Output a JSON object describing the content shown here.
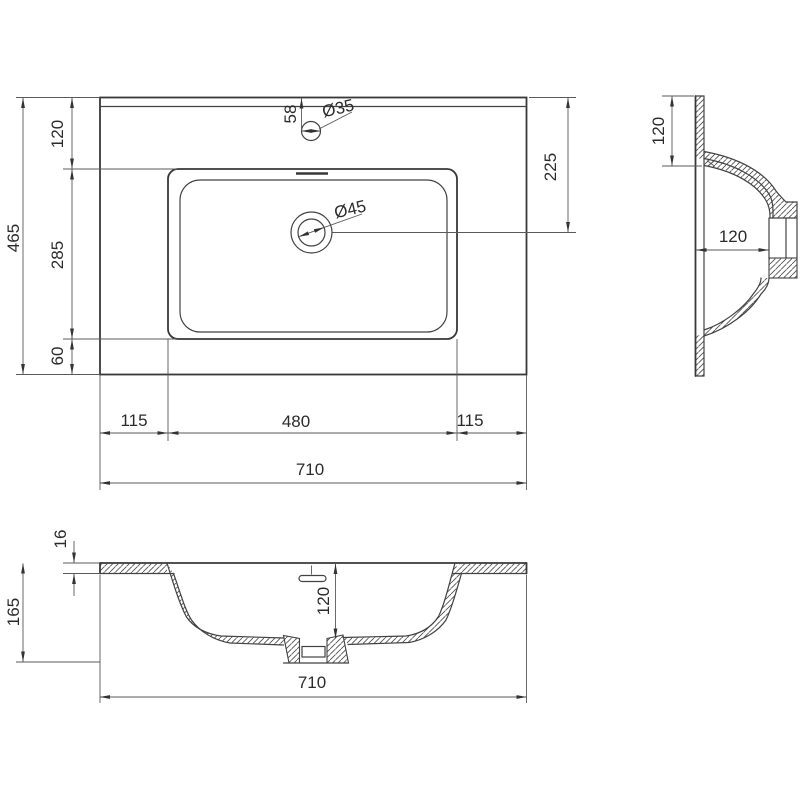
{
  "background": "#ffffff",
  "line_color": "#3a3a3a",
  "drawing": {
    "type": "technical-drawing",
    "subject": "rectangular inset washbasin shown in three orthographic section views with dimensions",
    "views": {
      "plan": {
        "name": "plan view",
        "dims": {
          "depth_total": "465",
          "back_to_bowl": "120",
          "bowl_depth": "285",
          "bowl_to_front": "60",
          "faucet_from_back": "58",
          "faucet_hole_dia": "Ø35",
          "drain_hole_dia": "Ø45",
          "drain_from_back": "225",
          "left_to_bowl": "115",
          "bowl_width": "480",
          "right_to_bowl": "115",
          "width_total": "710"
        }
      },
      "side": {
        "name": "side section view",
        "dims": {
          "back_to_bowl": "120",
          "bowl_inner_depth": "120"
        }
      },
      "front": {
        "name": "front section view",
        "dims": {
          "rim_thickness": "16",
          "height_total": "165",
          "bowl_inner_depth": "120",
          "width_total": "710"
        }
      }
    }
  }
}
